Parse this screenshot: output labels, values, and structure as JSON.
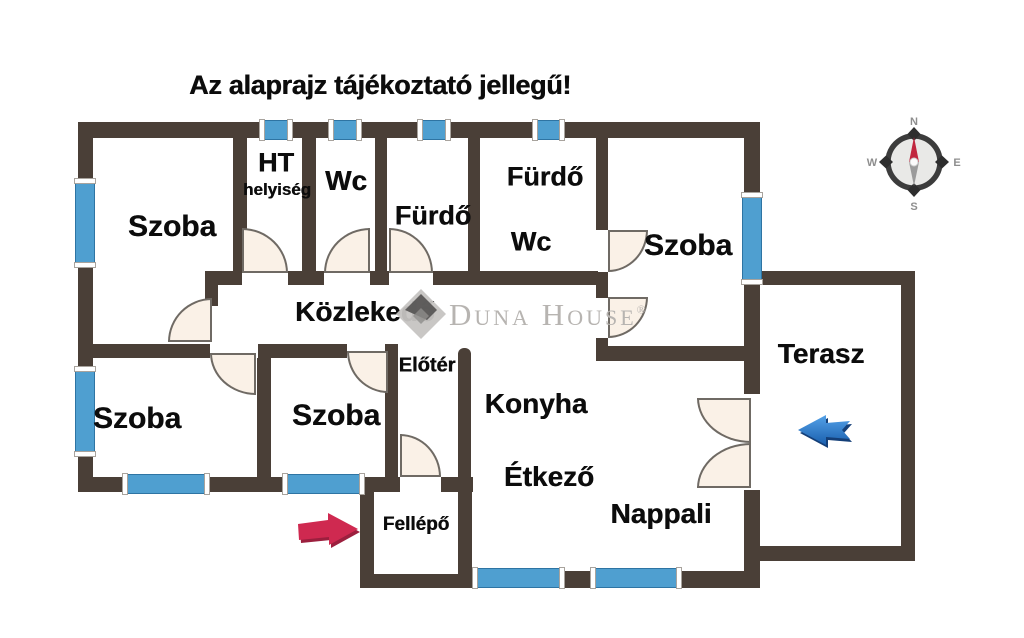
{
  "title": "Az alaprajz tájékoztató jellegű!",
  "watermark": {
    "text": "Duna House",
    "reg": "®"
  },
  "compass": {
    "n": "N",
    "e": "E",
    "s": "S",
    "w": "W"
  },
  "colors": {
    "wall": "#4a3f37",
    "window_blue": "#4f9fd0",
    "door_fill": "#faf1e7",
    "door_line": "#6f6a64",
    "label_text": "#0c0c0c",
    "watermark_gray": "#b7b4b1",
    "entrance_arrow_red": "#cf2950",
    "terrace_arrow_blue": "#2f86dc",
    "compass_letter_gray": "#8e8e8e",
    "compass_needle_red": "#c1273f"
  },
  "icons": [
    {
      "name": "entrance-arrow-icon",
      "direction": "right",
      "color": "#cf2950"
    },
    {
      "name": "terrace-arrow-icon",
      "direction": "left",
      "color": "#2f86dc"
    },
    {
      "name": "compass-rose",
      "letters": [
        "N",
        "E",
        "S",
        "W"
      ]
    },
    {
      "name": "watermark-diamond-logo"
    }
  ],
  "plan": {
    "labels": [
      {
        "name": "room-label-szoba-top-left",
        "text": "Szoba",
        "x": 172,
        "y": 227,
        "size": 30
      },
      {
        "name": "room-label-ht",
        "text": "HT",
        "x": 276,
        "y": 163,
        "size": 27
      },
      {
        "name": "room-label-ht-helyiseg",
        "text": "helyiség",
        "x": 277,
        "y": 190,
        "size": 17
      },
      {
        "name": "room-label-wc",
        "text": "Wc",
        "x": 346,
        "y": 181,
        "size": 28
      },
      {
        "name": "room-label-furdo",
        "text": "Fürdő",
        "x": 433,
        "y": 216,
        "size": 27
      },
      {
        "name": "room-label-furdo-wc-line1",
        "text": "Fürdő",
        "x": 545,
        "y": 177,
        "size": 27
      },
      {
        "name": "room-label-furdo-wc-line2",
        "text": "Wc",
        "x": 531,
        "y": 242,
        "size": 27
      },
      {
        "name": "room-label-szoba-top-right",
        "text": "Szoba",
        "x": 688,
        "y": 246,
        "size": 30
      },
      {
        "name": "room-label-kozlekedo",
        "text": "Közlekedő",
        "x": 365,
        "y": 312,
        "size": 28
      },
      {
        "name": "room-label-eloter",
        "text": "Előtér",
        "x": 427,
        "y": 366,
        "size": 20
      },
      {
        "name": "room-label-szoba-bottom-left",
        "text": "Szoba",
        "x": 137,
        "y": 419,
        "size": 30
      },
      {
        "name": "room-label-szoba-bottom-mid",
        "text": "Szoba",
        "x": 336,
        "y": 416,
        "size": 30
      },
      {
        "name": "room-label-konyha",
        "text": "Konyha",
        "x": 536,
        "y": 404,
        "size": 28
      },
      {
        "name": "room-label-etkezo",
        "text": "Étkező",
        "x": 549,
        "y": 477,
        "size": 28
      },
      {
        "name": "room-label-nappali",
        "text": "Nappali",
        "x": 661,
        "y": 514,
        "size": 28
      },
      {
        "name": "room-label-fellepo",
        "text": "Fellépő",
        "x": 416,
        "y": 525,
        "size": 19
      },
      {
        "name": "room-label-terasz",
        "text": "Terasz",
        "x": 821,
        "y": 354,
        "size": 28
      }
    ],
    "walls": [
      [
        78,
        122,
        682,
        16
      ],
      [
        78,
        122,
        15,
        370
      ],
      [
        78,
        477,
        322,
        15
      ],
      [
        441,
        477,
        32,
        15
      ],
      [
        360,
        477,
        14,
        111
      ],
      [
        360,
        574,
        112,
        14
      ],
      [
        458,
        477,
        14,
        111
      ],
      [
        458,
        571,
        302,
        17
      ],
      [
        744,
        122,
        16,
        76
      ],
      [
        744,
        280,
        16,
        114
      ],
      [
        744,
        490,
        16,
        98
      ],
      [
        760,
        271,
        143,
        14
      ],
      [
        901,
        271,
        14,
        290
      ],
      [
        760,
        546,
        155,
        15
      ],
      [
        233,
        138,
        14,
        135
      ],
      [
        302,
        138,
        14,
        135
      ],
      [
        375,
        138,
        12,
        135
      ],
      [
        468,
        138,
        12,
        135
      ],
      [
        596,
        138,
        12,
        92
      ],
      [
        596,
        272,
        12,
        26
      ],
      [
        596,
        338,
        12,
        20
      ],
      [
        208,
        271,
        34,
        14
      ],
      [
        288,
        271,
        36,
        14
      ],
      [
        370,
        271,
        19,
        14
      ],
      [
        433,
        271,
        165,
        14
      ],
      [
        205,
        271,
        13,
        35
      ],
      [
        78,
        344,
        132,
        14
      ],
      [
        258,
        344,
        89,
        14
      ],
      [
        385,
        344,
        13,
        133
      ],
      [
        257,
        358,
        14,
        119
      ],
      [
        596,
        346,
        164,
        15
      ],
      [
        458,
        348,
        13,
        130,
        "6px 6px 0 0"
      ]
    ],
    "windows": [
      {
        "x": 264,
        "y": 120,
        "w": 24,
        "h": 20,
        "o": "h"
      },
      {
        "x": 333,
        "y": 120,
        "w": 24,
        "h": 20,
        "o": "h"
      },
      {
        "x": 422,
        "y": 120,
        "w": 24,
        "h": 20,
        "o": "h"
      },
      {
        "x": 537,
        "y": 120,
        "w": 23,
        "h": 20,
        "o": "h"
      },
      {
        "x": 75,
        "y": 183,
        "w": 20,
        "h": 80,
        "o": "v"
      },
      {
        "x": 75,
        "y": 371,
        "w": 20,
        "h": 81,
        "o": "v"
      },
      {
        "x": 742,
        "y": 197,
        "w": 20,
        "h": 83,
        "o": "v"
      },
      {
        "x": 127,
        "y": 474,
        "w": 78,
        "h": 20,
        "o": "h"
      },
      {
        "x": 287,
        "y": 474,
        "w": 73,
        "h": 20,
        "o": "h"
      },
      {
        "x": 477,
        "y": 568,
        "w": 83,
        "h": 20,
        "o": "h"
      },
      {
        "x": 595,
        "y": 568,
        "w": 82,
        "h": 20,
        "o": "h"
      }
    ],
    "doors": [
      {
        "x": 168,
        "y": 298,
        "w": 44,
        "h": 44,
        "c": "tl"
      },
      {
        "x": 242,
        "y": 228,
        "w": 46,
        "h": 45,
        "c": "tr"
      },
      {
        "x": 324,
        "y": 228,
        "w": 46,
        "h": 45,
        "c": "tl"
      },
      {
        "x": 389,
        "y": 228,
        "w": 44,
        "h": 45,
        "c": "tr"
      },
      {
        "x": 608,
        "y": 230,
        "w": 40,
        "h": 42,
        "c": "br"
      },
      {
        "x": 608,
        "y": 297,
        "w": 40,
        "h": 41,
        "c": "br"
      },
      {
        "x": 210,
        "y": 353,
        "w": 46,
        "h": 42,
        "c": "bl"
      },
      {
        "x": 347,
        "y": 351,
        "w": 41,
        "h": 42,
        "c": "bl"
      },
      {
        "x": 400,
        "y": 434,
        "w": 41,
        "h": 43,
        "c": "tr"
      },
      {
        "x": 697,
        "y": 398,
        "w": 54,
        "h": 45,
        "c": "bl"
      },
      {
        "x": 697,
        "y": 443,
        "w": 54,
        "h": 45,
        "c": "tl"
      }
    ]
  }
}
